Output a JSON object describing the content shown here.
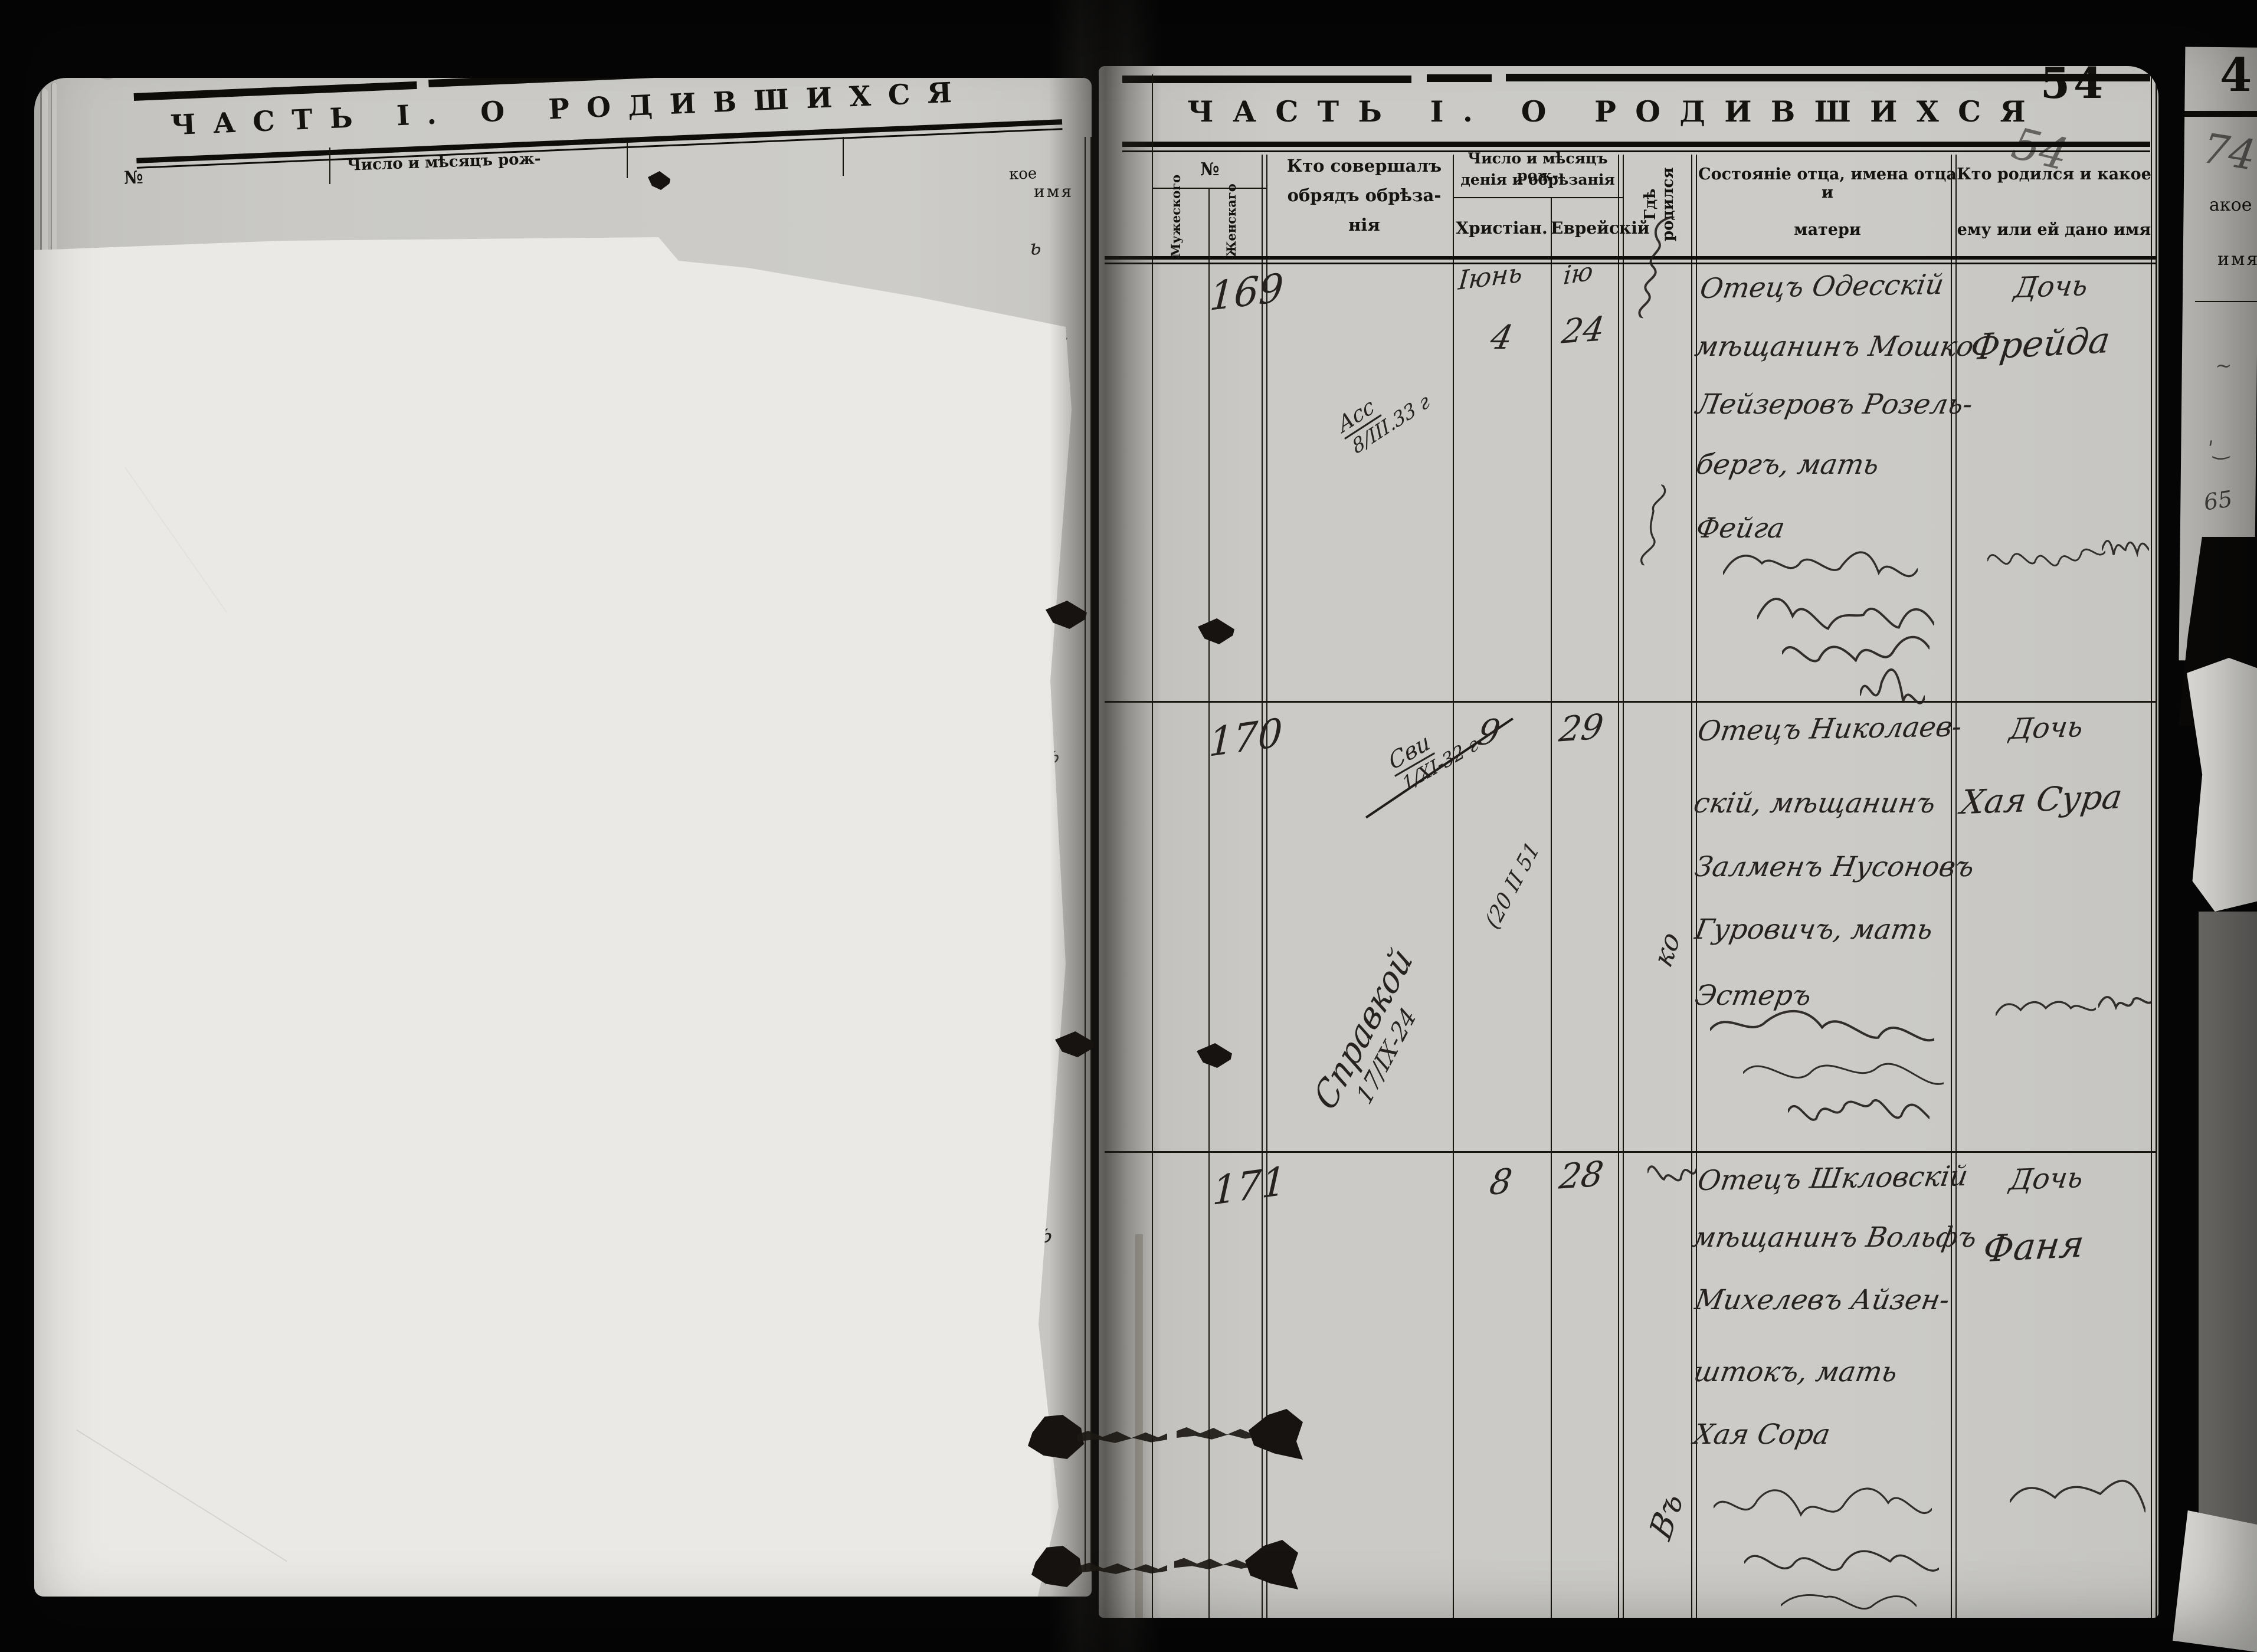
{
  "meta": {
    "printed_page_number": "54",
    "pencil_page_number": "54",
    "left_pencil_number": "53"
  },
  "left_page": {
    "title": "ЧАСТЬ I. О РОДИВШИХСЯ",
    "header_no": "№",
    "header_birthdate": "Число и мѣсяцъ рож-",
    "fragment_kakoe": "кое",
    "fragment_imya": "имя",
    "edge_fragments": [
      "ь",
      "на",
      "с",
      "ъ",
      "съ",
      "чъ",
      "евъ"
    ]
  },
  "right_page": {
    "title": "ЧАСТЬ I. О РОДИВШИХСЯ",
    "columns": {
      "no": "№",
      "male": "Мужеского",
      "female": "Женскаго",
      "officiant": [
        "Кто совершалъ",
        "обрядъ обрѣза-",
        "нія"
      ],
      "dates": [
        "Число и мѣсяцъ рож-",
        "денія и обрѣзанія"
      ],
      "christian": "Христіан.",
      "jewish": "Еврейскій",
      "birthplace": "Гдѣ родился",
      "parents": [
        "Состояніе отца, имена отца и",
        "матери"
      ],
      "child": [
        "Кто родился и какое",
        "ему или ей дано имя"
      ]
    },
    "entries": [
      {
        "no": "169",
        "note": [
          "Асс",
          "8/ІІІ.33 г"
        ],
        "christian_month": "Іюнь",
        "christian_day": "4",
        "jewish_month": "ію",
        "jewish_day": "24",
        "father_lines": [
          "Отецъ Одесскій",
          "мѣщанинъ Мошко",
          "Лейзеровъ Розель-",
          "бергъ, мать",
          "Фейга"
        ],
        "child_title": "Дочь",
        "child_name": "Фрейда"
      },
      {
        "no": "170",
        "note_crossed": [
          "Сви",
          "1/ХІ-32 г"
        ],
        "note_diagonal": [
          "Справкой",
          "17/ІХ-24"
        ],
        "note_small": "(20 ІІ 51",
        "christian_day": "9",
        "jewish_day": "29",
        "birthplace": "ко",
        "father_lines": [
          "Отецъ Николаев-",
          "скій, мѣщанинъ",
          "Залменъ Нусоновъ",
          "Гуровичъ, мать",
          "Эстеръ"
        ],
        "child_title": "Дочь",
        "child_name": "Хая Сура"
      },
      {
        "no": "171",
        "christian_day": "8",
        "jewish_day": "28",
        "birthplace": "Въ",
        "father_lines": [
          "Отецъ Шкловскій",
          "мѣщанинъ Вольфъ",
          "Михелевъ Айзен-",
          "штокъ, мать",
          "Хая Сора"
        ],
        "child_title": "Дочь",
        "child_name": "Фаня"
      }
    ]
  },
  "behind_page": {
    "printed_number": "4",
    "pencil_number": "74",
    "fragment_kakoe": "акое",
    "fragment_imya": "имя",
    "fragment_hw": "65"
  }
}
